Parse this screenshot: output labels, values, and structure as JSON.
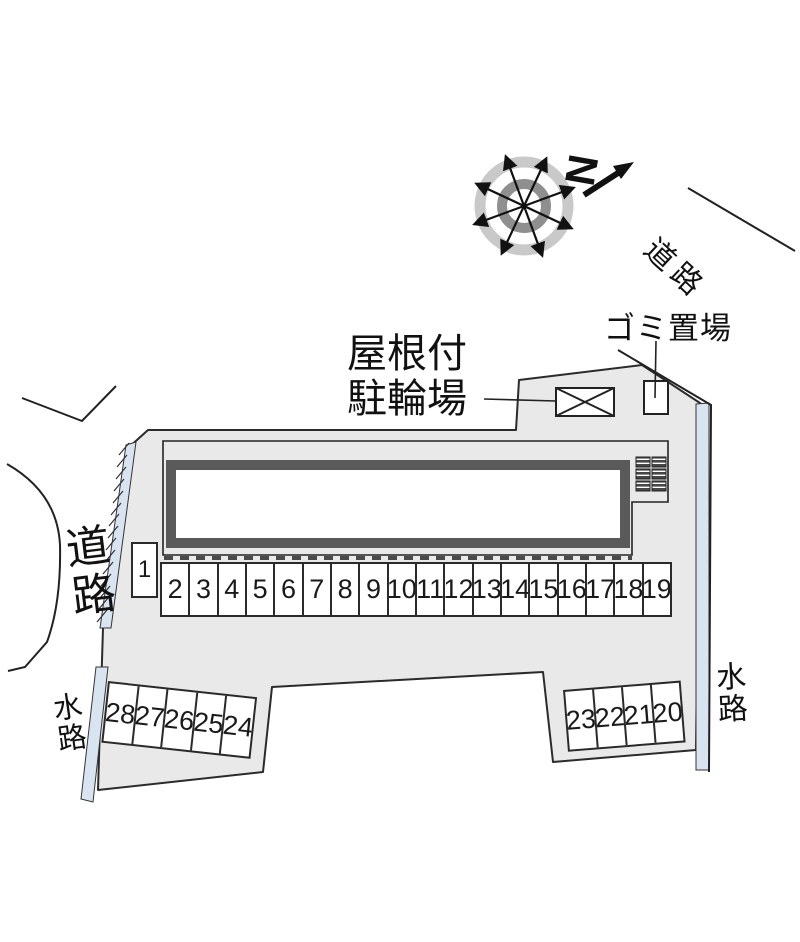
{
  "labels": {
    "road_left": "道路",
    "road_top_right": "道路",
    "waterway_left": "水路",
    "waterway_right": "水路",
    "garbage_area": "ゴミ置場",
    "bicycle_line1": "屋根付",
    "bicycle_line2": "駐輪場",
    "north_letter": "N"
  },
  "parking": {
    "space_1": "1",
    "row_main": [
      "2",
      "3",
      "4",
      "5",
      "6",
      "7",
      "8",
      "9",
      "10",
      "11",
      "12",
      "13",
      "14",
      "15",
      "16",
      "17",
      "18",
      "19"
    ],
    "block_sw": [
      "28",
      "27",
      "26",
      "25",
      "24"
    ],
    "block_se": [
      "23",
      "22",
      "21",
      "20"
    ]
  },
  "colors": {
    "site_fill": "#e9e9e9",
    "outline": "#2b2b2b",
    "building_wall": "#5a5a5a",
    "water_fill": "#d9e4f1",
    "compass_outer_ring": "#c9c9c9",
    "compass_inner_ring": "#8f8f8f"
  }
}
